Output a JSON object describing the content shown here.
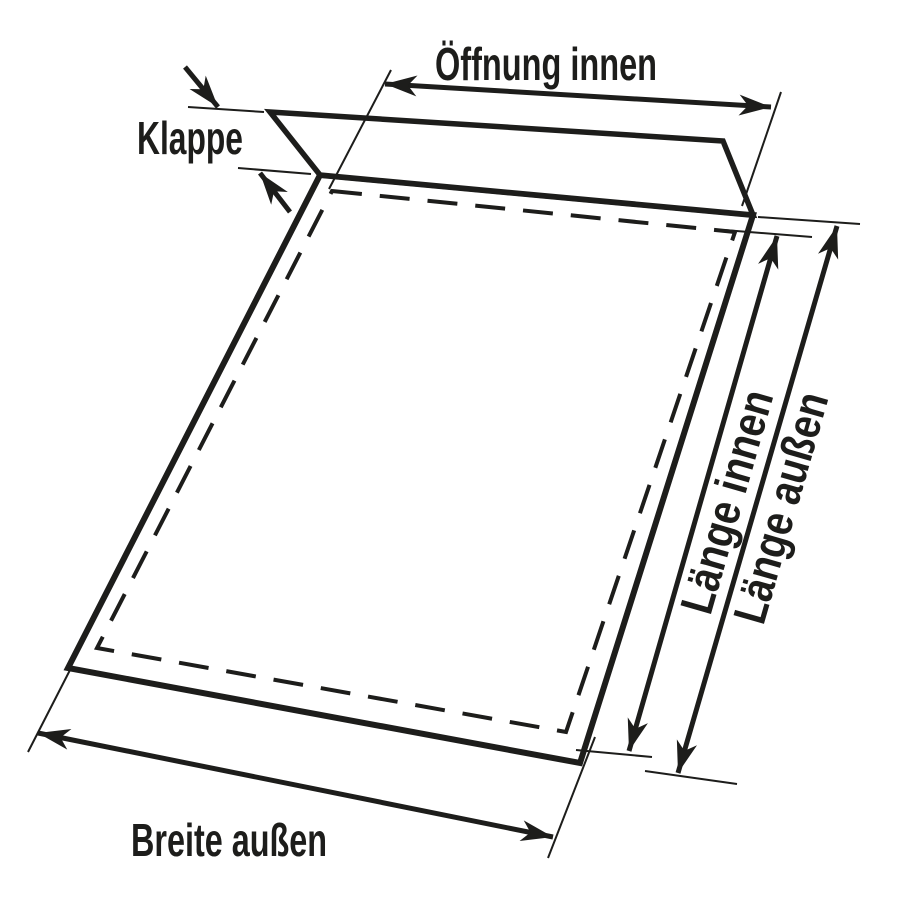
{
  "diagram": {
    "type": "envelope-dimension-diagram",
    "labels": {
      "oeffnung_innen": "Öffnung innen",
      "klappe": "Klappe",
      "laenge_innen": "Länge innen",
      "laenge_aussen": "Länge außen",
      "breite_aussen": "Breite außen"
    },
    "colors": {
      "ink": "#1d1d1b",
      "background": "#ffffff"
    }
  }
}
